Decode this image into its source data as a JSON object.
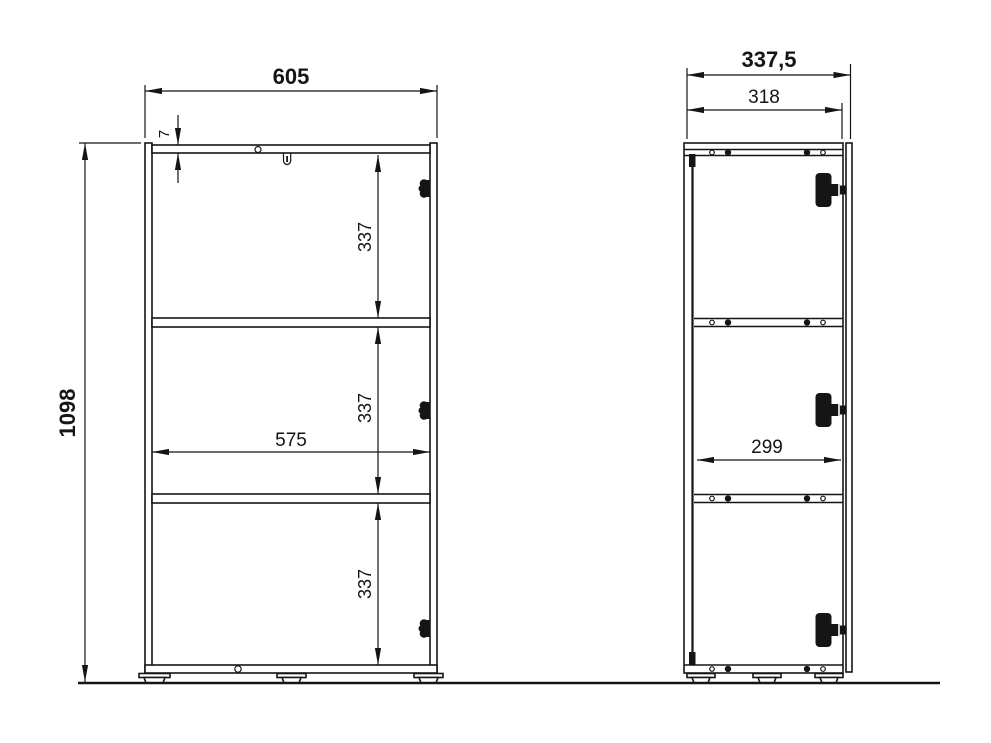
{
  "front_view": {
    "dimensions": {
      "overall_width": "605",
      "top_panel_thickness": "7",
      "overall_height": "1098",
      "inner_width": "575",
      "compartment_heights": [
        "337",
        "337",
        "337"
      ]
    }
  },
  "side_view": {
    "dimensions": {
      "overall_depth": "337,5",
      "carcass_depth": "318",
      "inner_depth": "299"
    }
  },
  "colors": {
    "line": "#151515",
    "background": "#ffffff"
  }
}
